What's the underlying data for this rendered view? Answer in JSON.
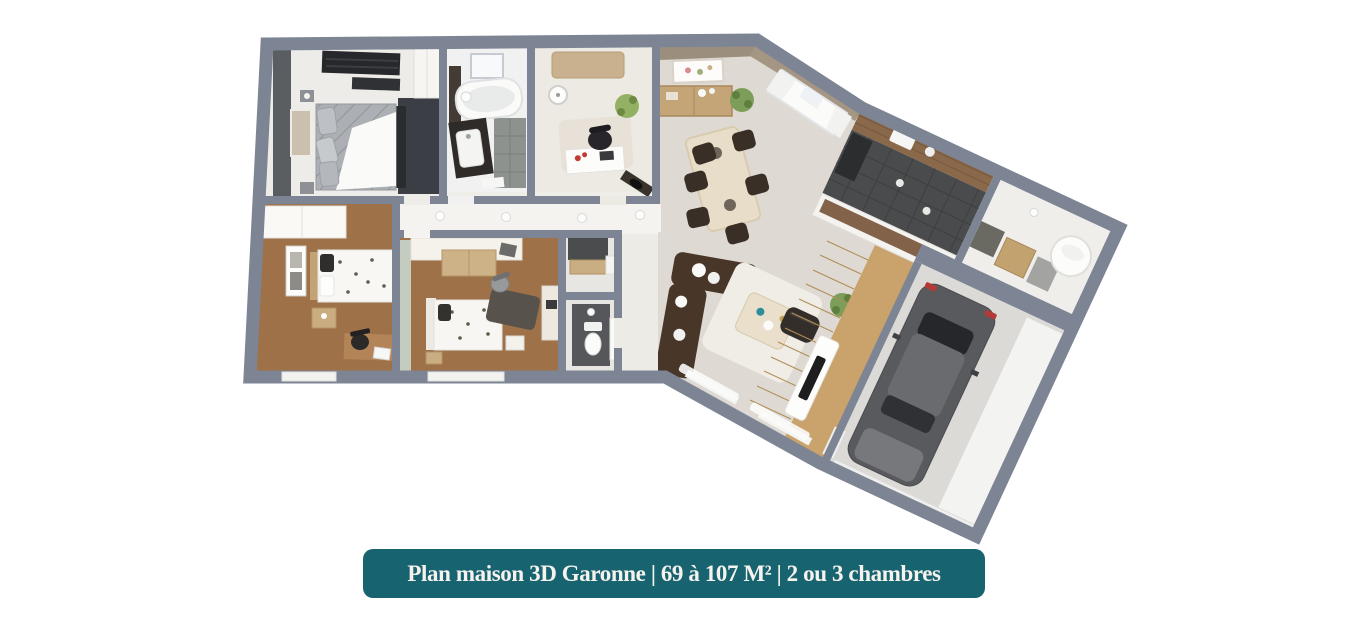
{
  "banner": {
    "label": "Plan maison 3D Garonne | 69 à 107 M² | 2 ou 3 chambres"
  },
  "floorplan": {
    "type": "3d-floor-plan",
    "rooms": [
      {
        "id": "master-bedroom"
      },
      {
        "id": "bathroom"
      },
      {
        "id": "office-bedroom"
      },
      {
        "id": "hallway"
      },
      {
        "id": "bedroom-2"
      },
      {
        "id": "bedroom-3"
      },
      {
        "id": "wc"
      },
      {
        "id": "closet"
      },
      {
        "id": "living-dining-room"
      },
      {
        "id": "kitchen"
      },
      {
        "id": "utility-room"
      },
      {
        "id": "garage"
      }
    ]
  },
  "colors": {
    "banner_bg": "#176470",
    "banner_text": "#F6F3EE",
    "wall": "#7D8594",
    "floor_light": "#EFEDE8",
    "floor_living": "#DEDAD3",
    "floor_wood": "#9E7149",
    "floor_tile_dark": "#4A4B4D",
    "floor_garage": "#DBDAD7",
    "accent_dark": "#3B3F45",
    "sage": "#C4CCC0",
    "sofa": "#483729",
    "tan": "#C3A577",
    "counter_wood": "#8A684A",
    "plant": "#7C9E58",
    "car": "#595A5E"
  }
}
